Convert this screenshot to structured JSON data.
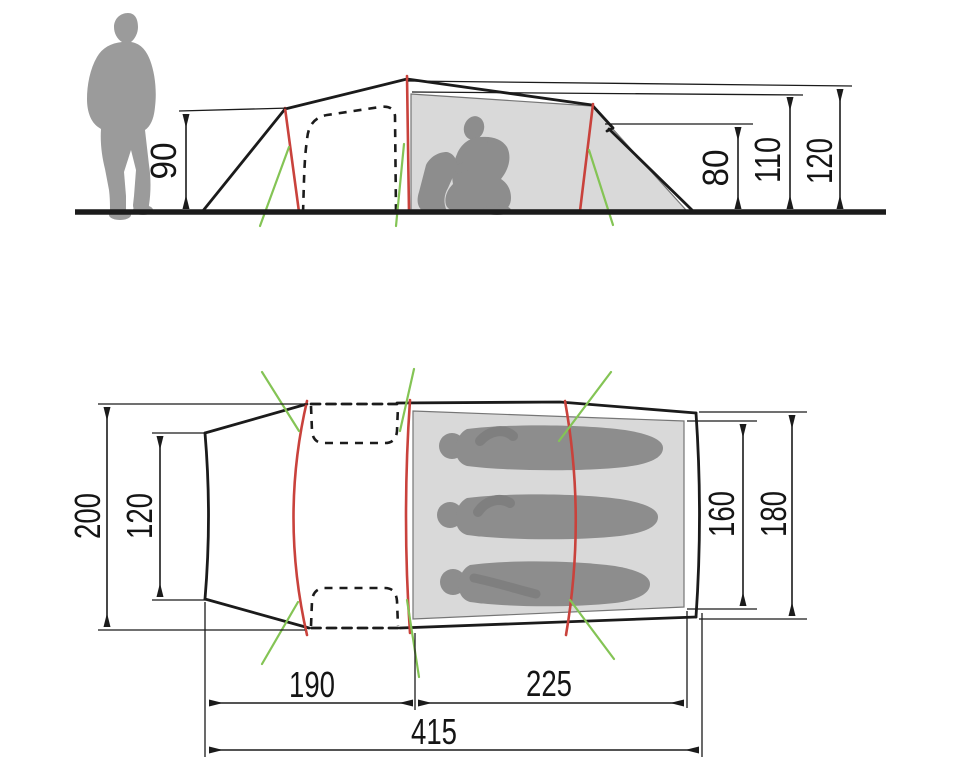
{
  "diagram": {
    "kind": "tent-dimension-drawing",
    "units": "cm",
    "views": [
      "side-elevation",
      "floor-plan"
    ]
  },
  "dims": {
    "side": {
      "vestibule_height": "90",
      "rear_height": "80",
      "inner_peak_height": "110",
      "peak_height": "120"
    },
    "plan": {
      "outer_width": "200",
      "front_width": "120",
      "inner_width": "160",
      "rear_width": "180",
      "vestibule_length": "190",
      "inner_length": "225",
      "total_length": "415"
    }
  },
  "colors": {
    "line": "#1b1b1b",
    "pole_red": "#c9423c",
    "guy_green": "#84c455",
    "panel_gray": "#d9d9d9",
    "figure_gray": "#9b9b9b",
    "figure_dark": "#8d8d8d",
    "arm_dark": "#7f7f7f",
    "background": "#ffffff"
  }
}
